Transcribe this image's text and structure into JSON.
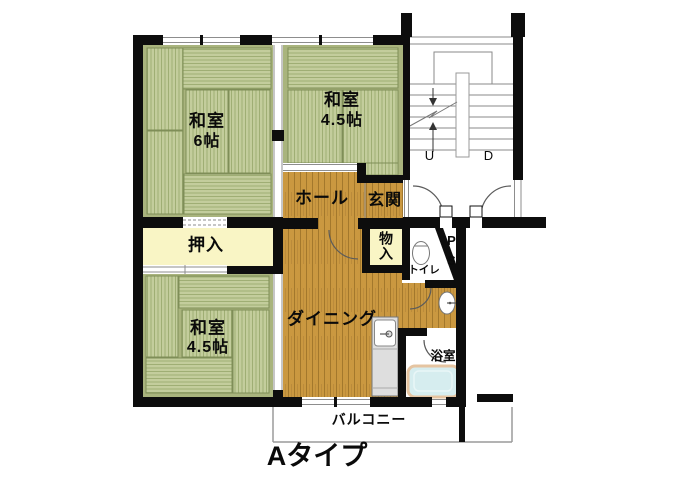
{
  "title": "Aタイプ",
  "plan": {
    "rooms": {
      "washitsu_6": {
        "name": "和室",
        "size": "6帖"
      },
      "washitsu_45_top": {
        "name": "和室",
        "size": "4.5帖"
      },
      "washitsu_45_bottom": {
        "name": "和室",
        "size": "4.5帖"
      },
      "hall": {
        "name": "ホール"
      },
      "genkan": {
        "name": "玄関"
      },
      "oshiire": {
        "name": "押入"
      },
      "monoire": {
        "name": "物入",
        "display": "物\n入"
      },
      "toilet": {
        "name": "トイレ"
      },
      "pipe_space": {
        "p": "P",
        "s": "S"
      },
      "dining": {
        "name": "ダイニング"
      },
      "bathroom": {
        "name": "浴室"
      },
      "balcony": {
        "name": "バルコニー"
      }
    },
    "stairs": {
      "up_label": "U",
      "down_label": "D"
    }
  },
  "colors": {
    "wall": "#0d0d0d",
    "tatami-base": "#a9b47d",
    "mat-fill": "#c3cd9c",
    "mat-border": "#7f8e58",
    "wood": "#ca9840",
    "wood-line": "#a3782c",
    "cream": "#f9f5c5",
    "tub-fill": "#d6edef",
    "tub-border": "#e5c4a1",
    "counter": "#dedede"
  }
}
